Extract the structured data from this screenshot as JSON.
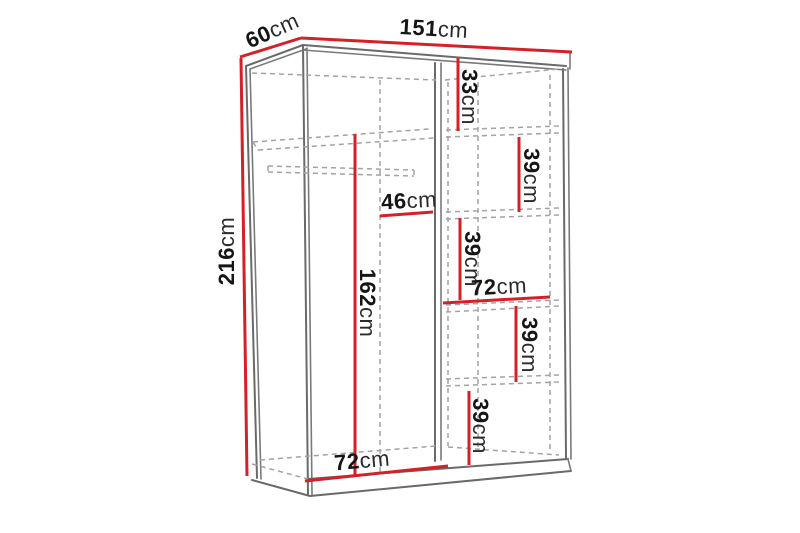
{
  "diagram": {
    "type": "furniture-dimension-drawing",
    "subject": "two-door sliding wardrobe with shelves and hanging rail",
    "unit": "cm",
    "colors": {
      "dimension_line": "#d42127",
      "structure_line": "#6a6a6a",
      "hidden_line": "#a3a3a3",
      "label_text": "#151515",
      "background": "#ffffff"
    },
    "dimensions": {
      "height": {
        "value": "216",
        "unit": "cm"
      },
      "depth": {
        "value": "60",
        "unit": "cm"
      },
      "width": {
        "value": "151",
        "unit": "cm"
      },
      "top_right_section": {
        "value": "33",
        "unit": "cm"
      },
      "shelf_gap_1": {
        "value": "39",
        "unit": "cm"
      },
      "upper_inner_width": {
        "value": "46",
        "unit": "cm"
      },
      "shelf_gap_2": {
        "value": "39",
        "unit": "cm"
      },
      "right_section_width": {
        "value": "72",
        "unit": "cm"
      },
      "shelf_gap_3": {
        "value": "39",
        "unit": "cm"
      },
      "shelf_gap_4": {
        "value": "39",
        "unit": "cm"
      },
      "hanging_space_height": {
        "value": "162",
        "unit": "cm"
      },
      "left_section_width": {
        "value": "72",
        "unit": "cm"
      }
    }
  }
}
